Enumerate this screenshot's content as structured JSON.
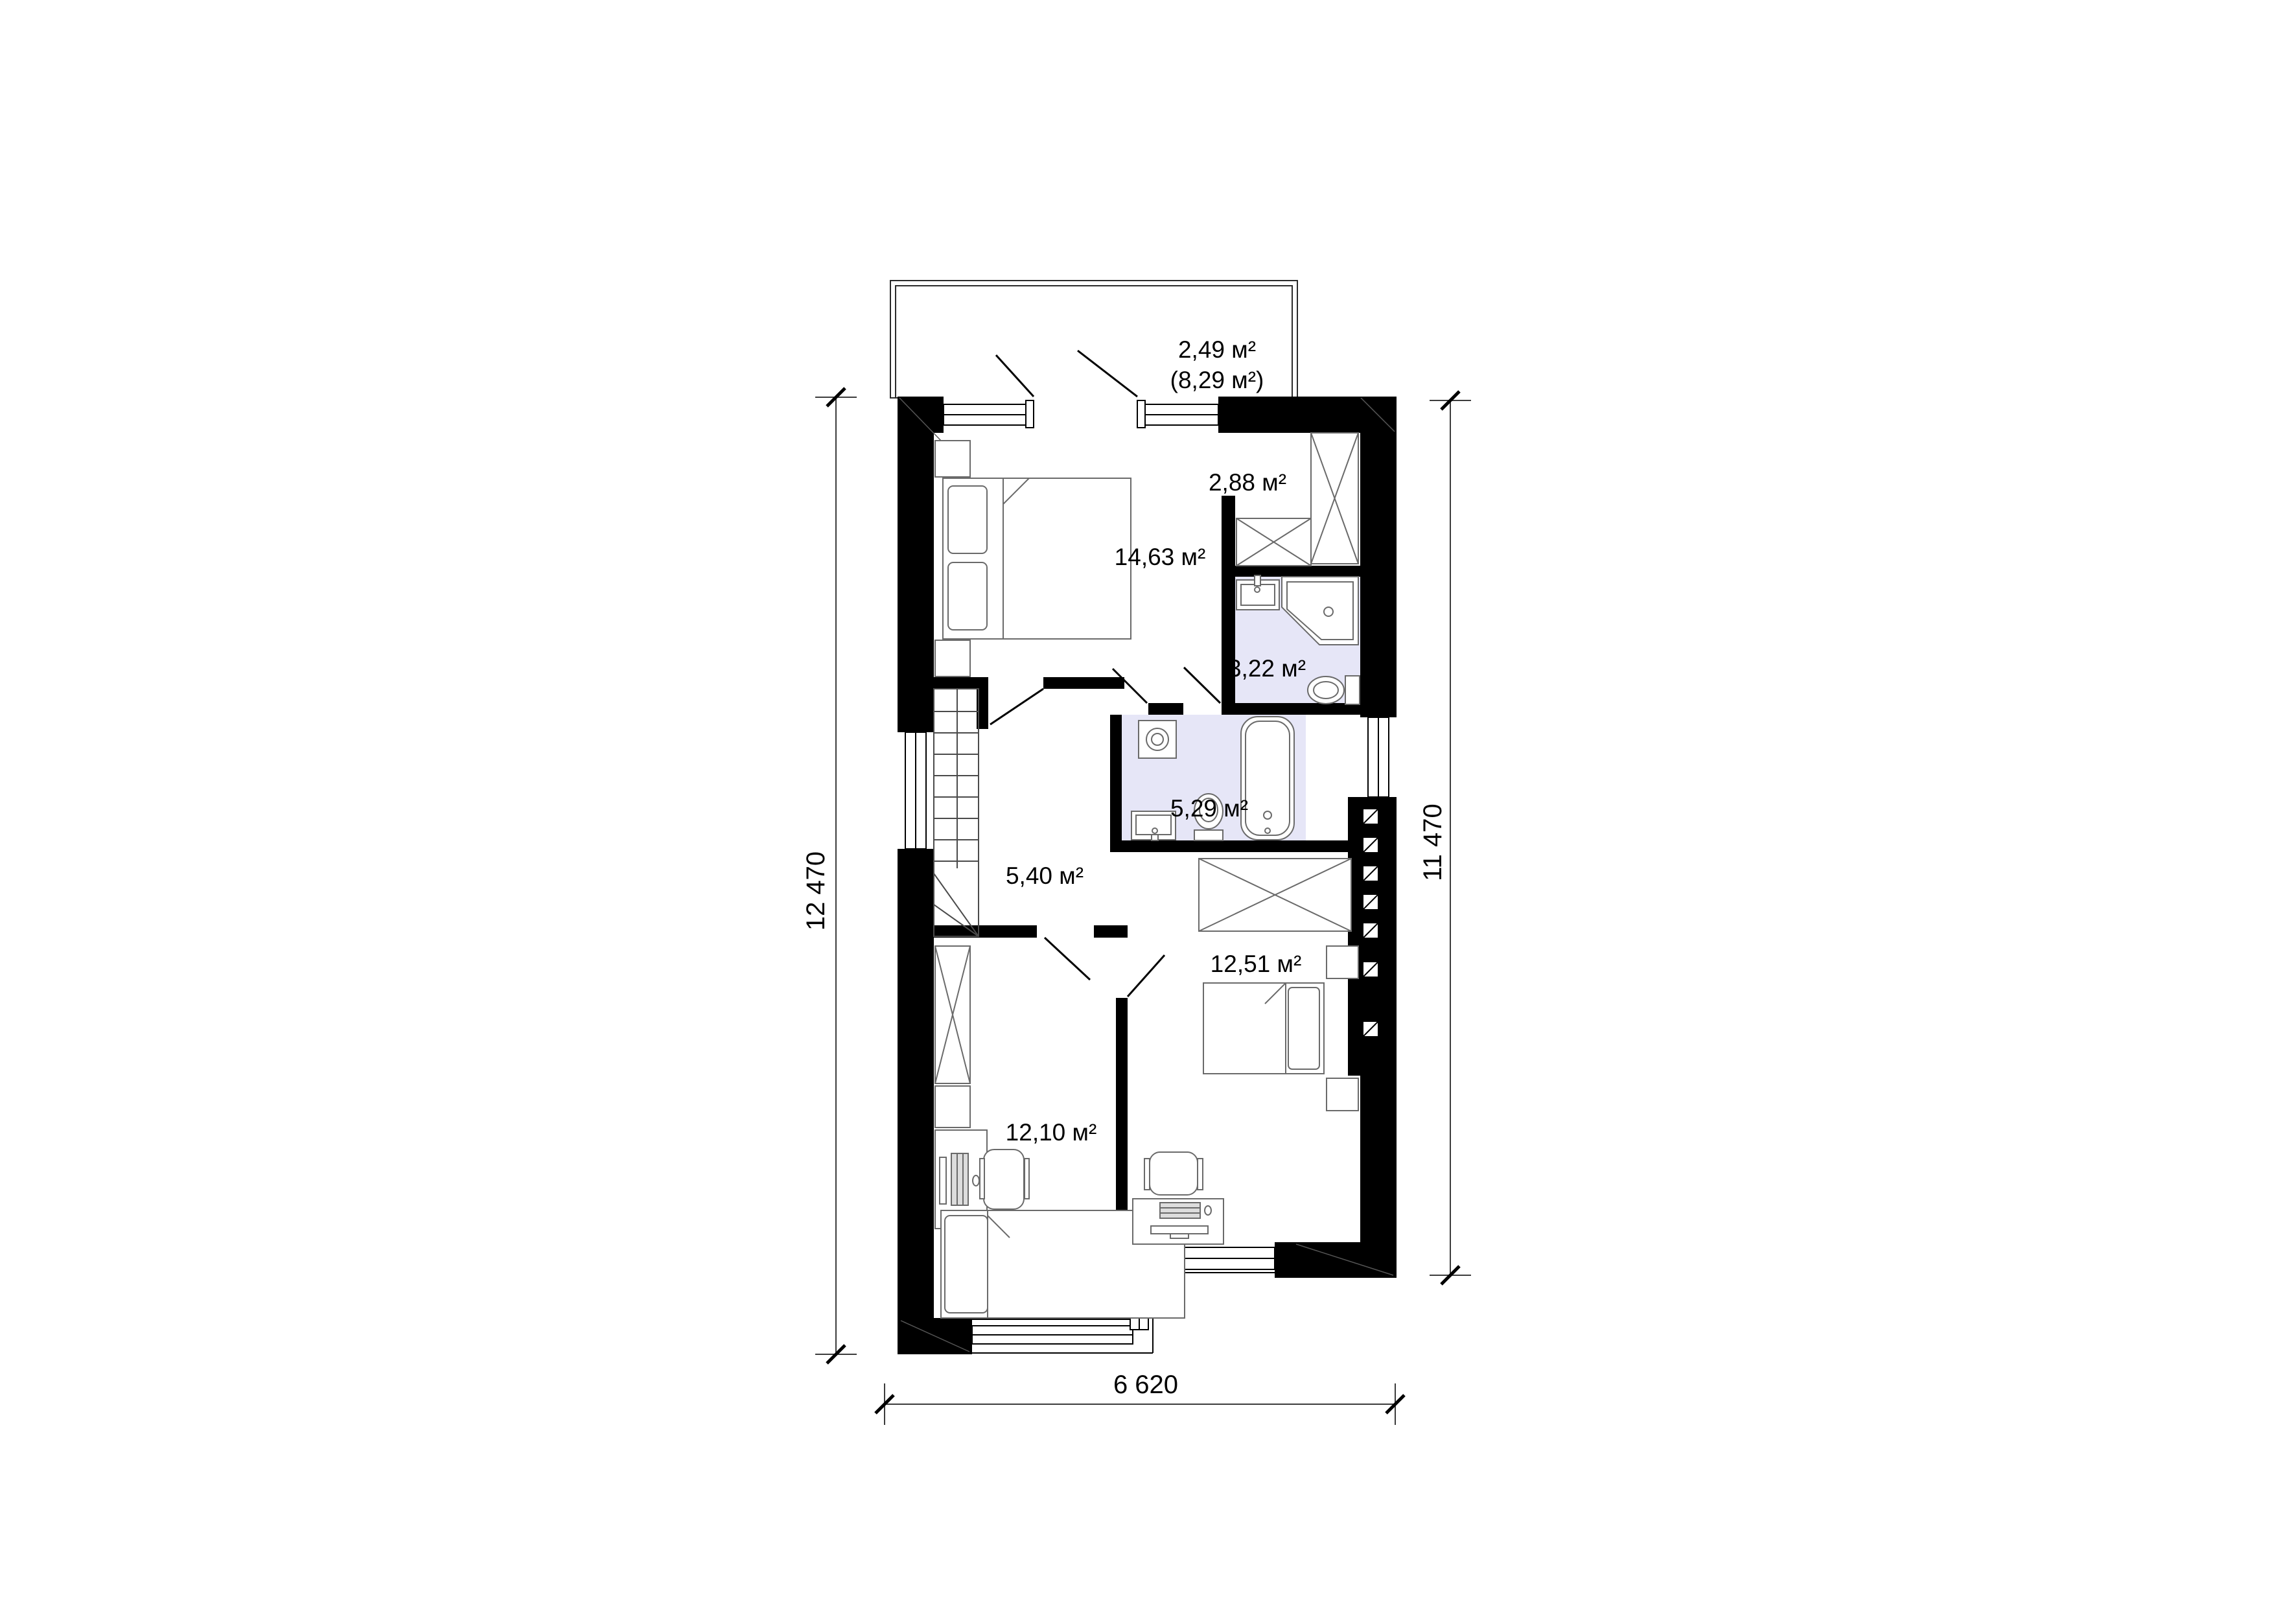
{
  "plan": {
    "balcony": {
      "line1": "2,49 м²",
      "line2": "(8,29 м²)"
    },
    "rooms": {
      "bedroom_main": "14,63 м²",
      "closet": "2,88 м²",
      "bath_small": "3,22 м²",
      "bath_main": "5,29 м²",
      "hallway": "5,40 м²",
      "bedroom_right": "12,51 м²",
      "bedroom_left": "12,10 м²"
    },
    "dimensions": {
      "left": "12 470",
      "right": "11 470",
      "bottom": "6 620"
    }
  },
  "colors": {
    "wall": "#000000",
    "bath_fill": "#e6e6f7",
    "furniture": "#6a6a6a",
    "dimension": "#3c3c3c"
  }
}
